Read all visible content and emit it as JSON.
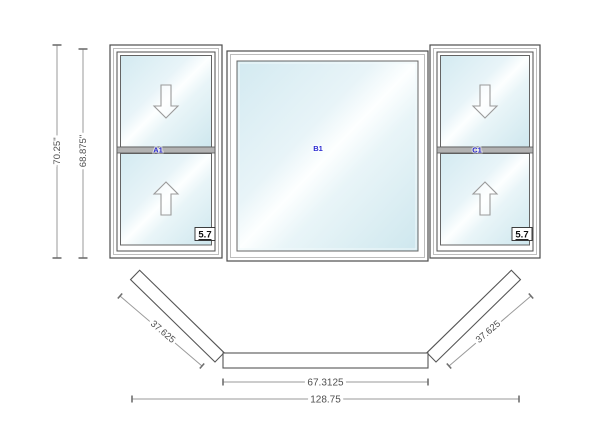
{
  "drawing": {
    "title": "bay-window-configuration",
    "elevation": {
      "dim_overall_height": "70.25\"",
      "dim_frame_height": "68.875\"",
      "units": [
        {
          "label": "A1",
          "type": "double-hung",
          "egress": "5.7"
        },
        {
          "label": "B1",
          "type": "picture"
        },
        {
          "label": "C1",
          "type": "double-hung",
          "egress": "5.7"
        }
      ]
    },
    "plan": {
      "dim_left_flanker": "37.625",
      "dim_center": "67.3125",
      "dim_right_flanker": "37.625",
      "dim_overall_width": "128.75"
    },
    "colors": {
      "glass_tint": "#d3eaf1",
      "label_blue": "#2a2ad0",
      "line_dark": "#4d4d4d",
      "line_gray": "#9a9a9a",
      "rail_gray": "#b2b2b2",
      "dim_text_gray": "#4f4f4f",
      "background": "#ffffff"
    }
  }
}
